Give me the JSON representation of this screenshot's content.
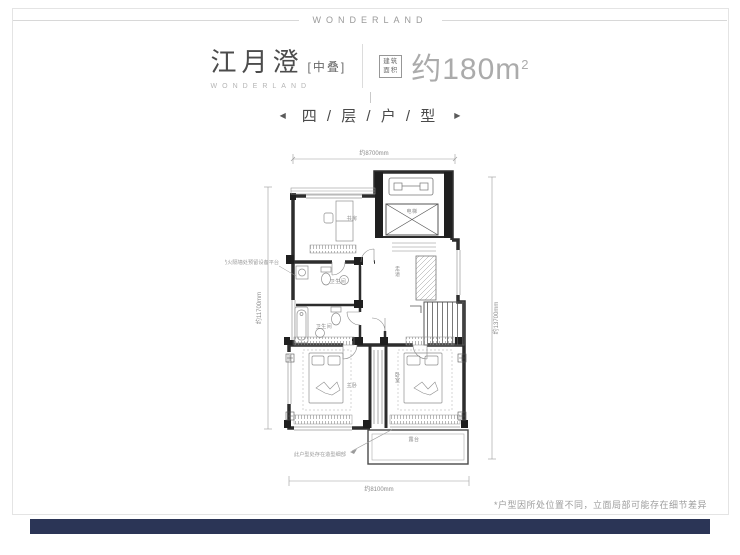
{
  "page": {
    "top_banner": "WONDERLAND"
  },
  "header": {
    "title": "江月澄",
    "title_suffix": "[中叠]",
    "subtitle": "WONDERLAND",
    "area_badge_top": "建筑",
    "area_badge_bottom": "面积",
    "area_value": "约180m",
    "area_sup": "2"
  },
  "section": {
    "left_arrow": "◀",
    "title": "四 / 层 / 户 / 型",
    "right_arrow": "▶"
  },
  "plan": {
    "dims": {
      "top": "约8700mm",
      "left": "约11700mm",
      "right": "约13700mm",
      "bottom": "约8100mm"
    },
    "labels": {
      "study": "书房",
      "elevator": "电梯",
      "corridor": "走道",
      "bath1": "卫生间",
      "bath2": "卫生间",
      "master": "主卧",
      "bedroom": "卧室",
      "terrace": "露台"
    },
    "notes": {
      "left": "防火隔墙处预留设备平台",
      "bottom": "此户型处存在造型细部"
    }
  },
  "footer": {
    "disclaimer": "*户型因所处位置不同，立面局部可能存在细节差异"
  },
  "colors": {
    "accent_bar": "#2b3556",
    "wall": "#2d2d2d",
    "dim_text": "#8a8a8a"
  }
}
